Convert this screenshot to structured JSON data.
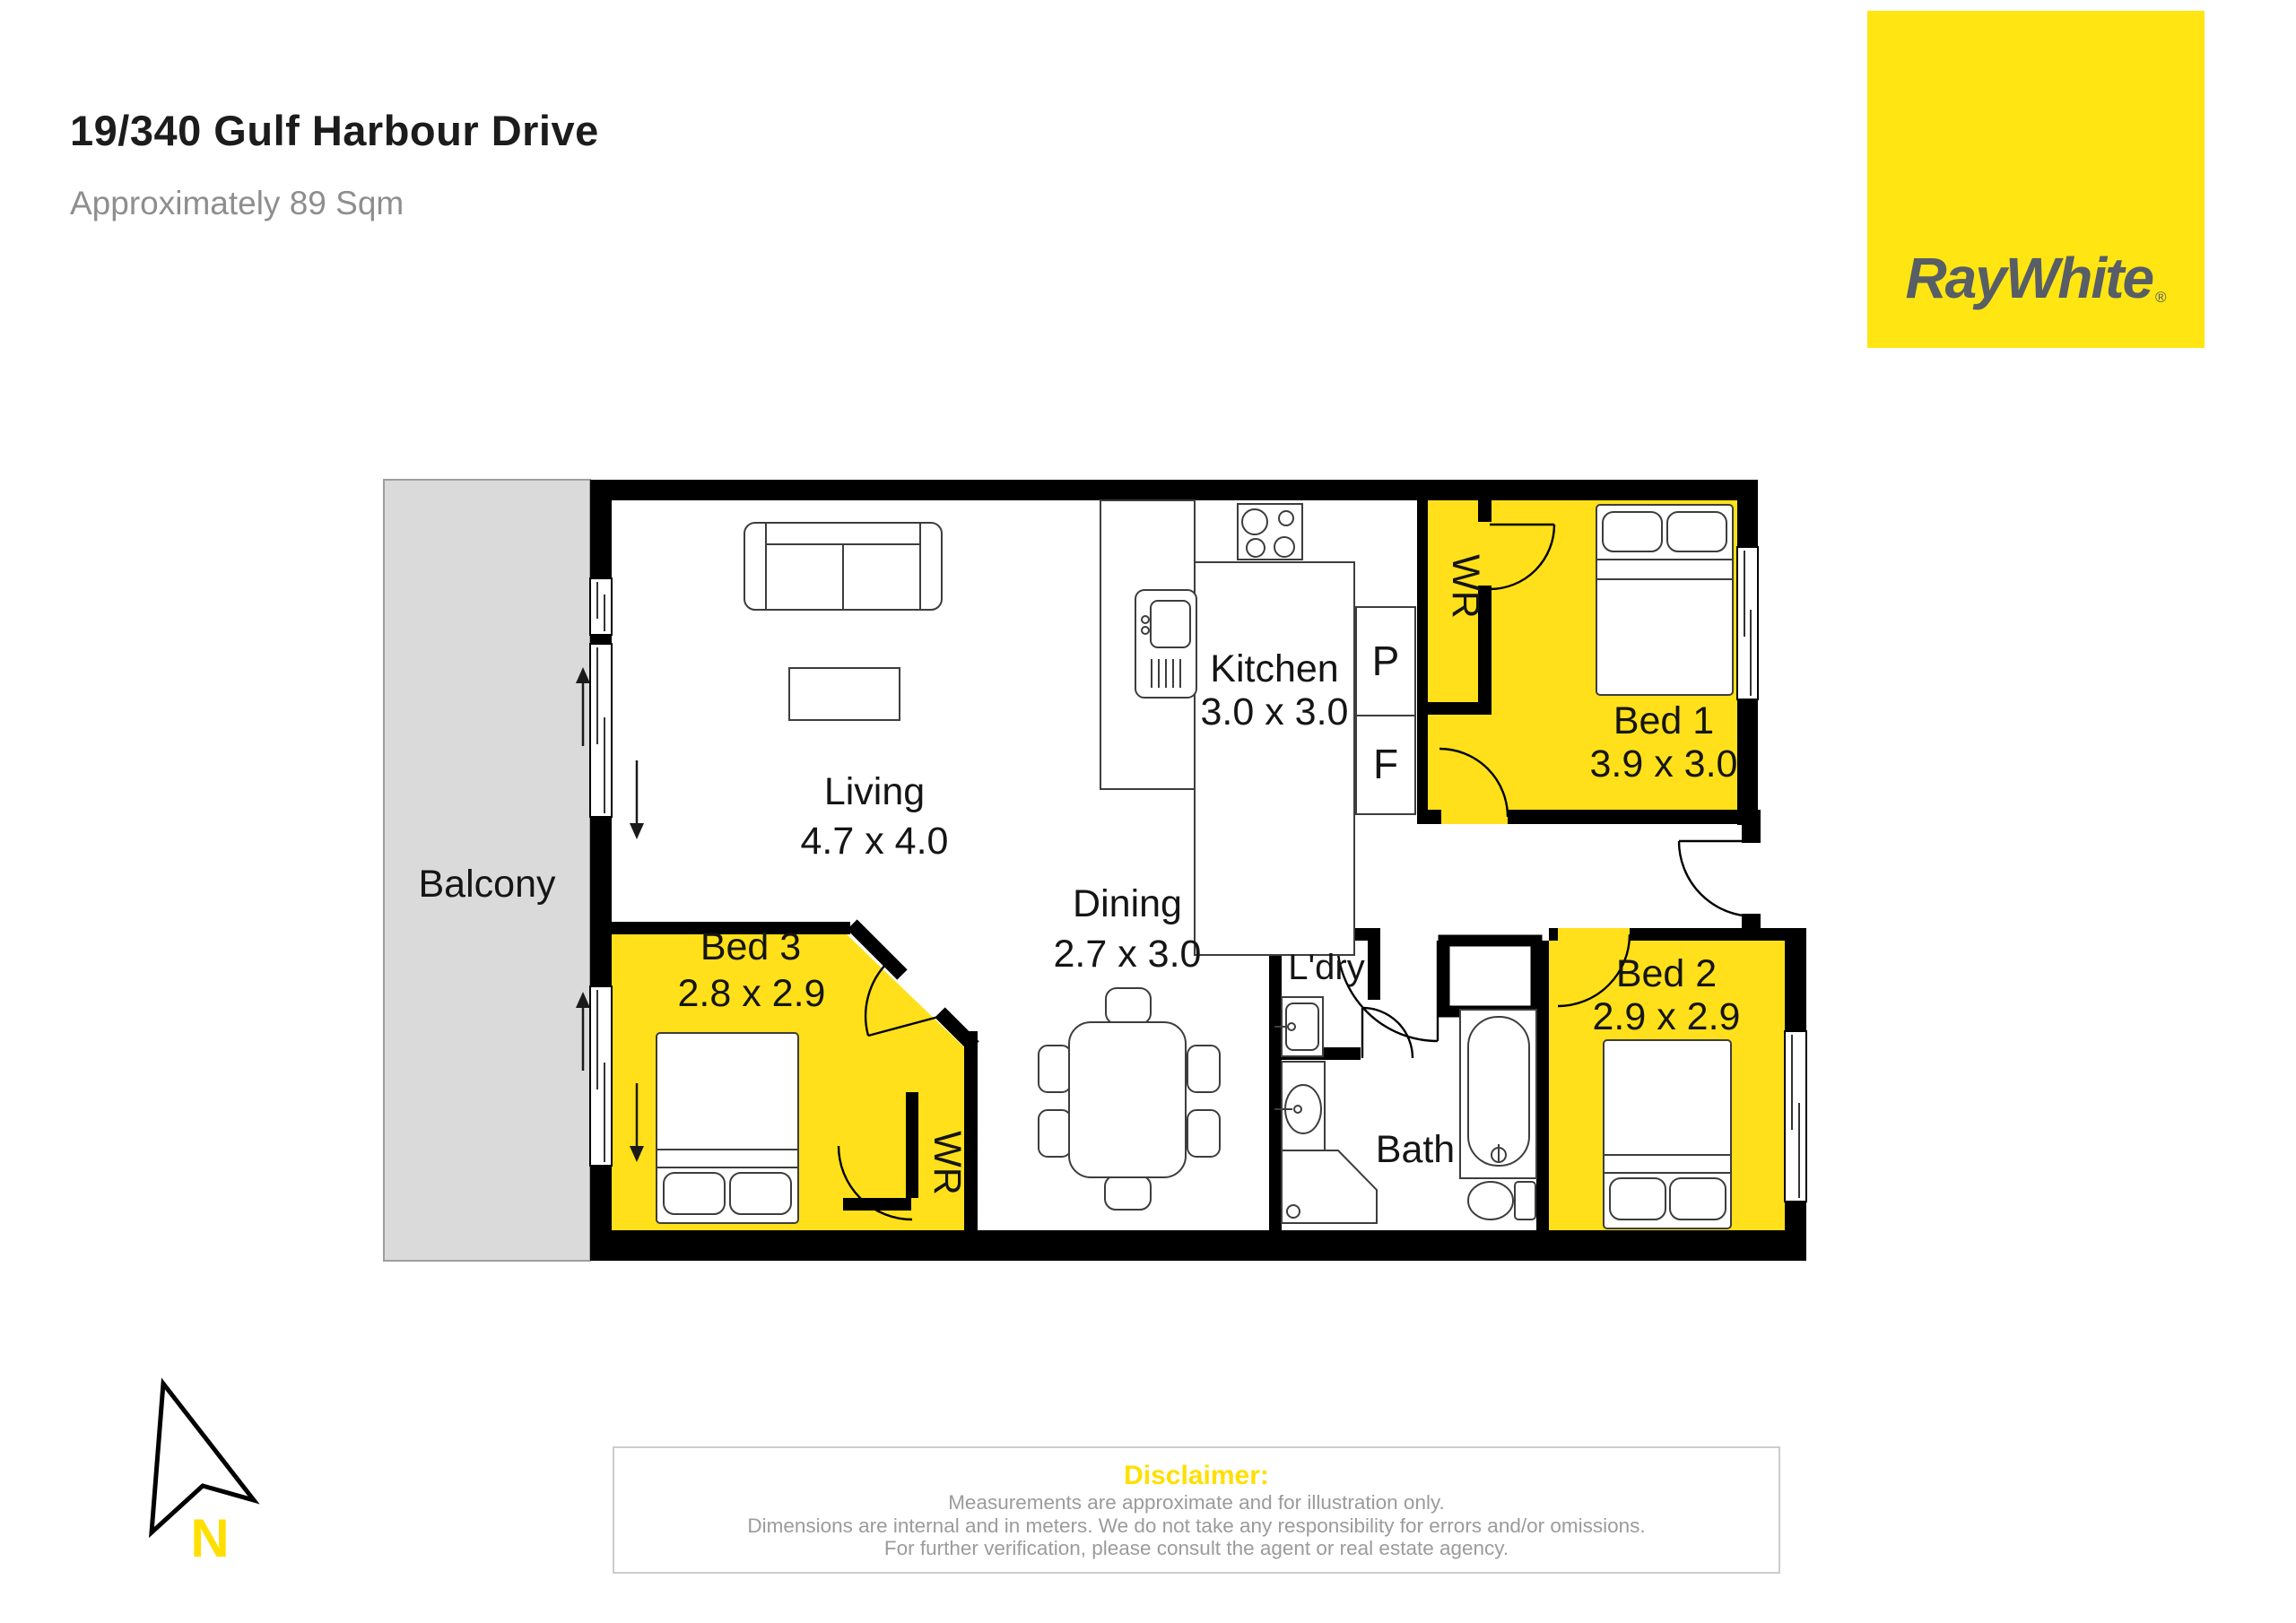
{
  "header": {
    "title": "19/340 Gulf Harbour Drive",
    "subtitle": "Approximately 89 Sqm"
  },
  "brand": {
    "name": "RayWhite",
    "mark": "®"
  },
  "compass": {
    "north": "N"
  },
  "rooms": {
    "balcony": {
      "label": "Balcony"
    },
    "living": {
      "label": "Living",
      "dims": "4.7 x 4.0"
    },
    "kitchen": {
      "label": "Kitchen",
      "dims": "3.0 x 3.0"
    },
    "dining": {
      "label": "Dining",
      "dims": "2.7 x 3.0"
    },
    "bed1": {
      "label": "Bed 1",
      "dims": "3.9 x 3.0"
    },
    "bed2": {
      "label": "Bed 2",
      "dims": "2.9 x 2.9"
    },
    "bed3": {
      "label": "Bed 3",
      "dims": "2.8 x 2.9"
    },
    "bath": {
      "label": "Bath"
    },
    "laundry": {
      "label": "L'dry"
    }
  },
  "storage": {
    "bed1_wardrobe": "WR",
    "bed3_wardrobe": "WR",
    "pantry": "P",
    "fridge": "F"
  },
  "disclaimer": {
    "heading": "Disclaimer:",
    "line1": "Measurements are approximate and for illustration only.",
    "line2": "Dimensions are internal and in meters. We do not take any responsibility for errors and/or omissions.",
    "line3": "For further verification, please consult the agent or real estate agency."
  },
  "colors": {
    "room_highlight": "#FFE01A",
    "brand_yellow": "#FFE512",
    "disclaimer_yellow": "#FFDF00",
    "balcony_gray": "#DADADA",
    "wall_black": "#000000",
    "muted_text": "#9B9B9B"
  }
}
